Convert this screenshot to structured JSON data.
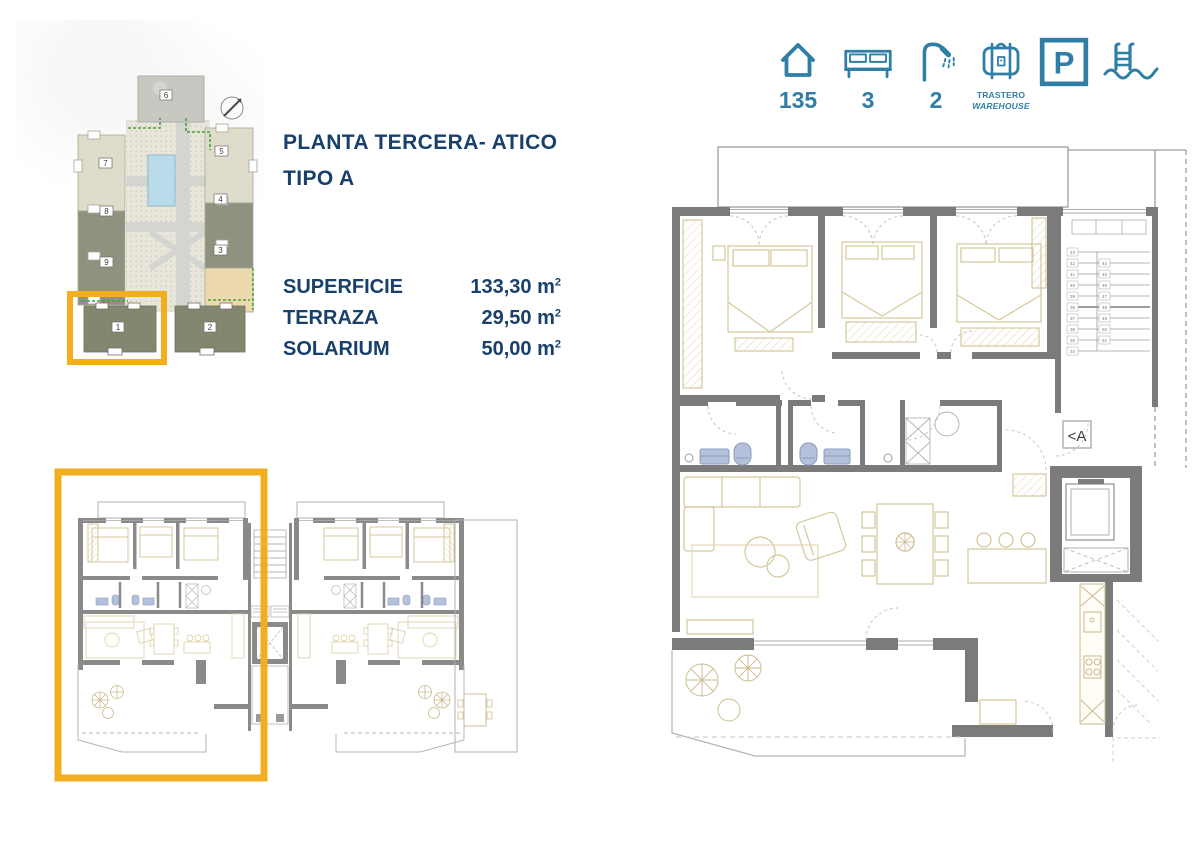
{
  "header": {
    "line1": "PLANTA TERCERA- ATICO",
    "line2": "TIPO A"
  },
  "measurements": {
    "rows": [
      {
        "label": "SUPERFICIE",
        "value": "133,30 m",
        "sup": "2"
      },
      {
        "label": "TERRAZA",
        "value": "29,50 m",
        "sup": "2"
      },
      {
        "label": "SOLARIUM",
        "value": "50,00 m",
        "sup": "2"
      }
    ]
  },
  "amenities": {
    "house": {
      "value": "135"
    },
    "bed": {
      "value": "3"
    },
    "shower": {
      "value": "2"
    },
    "storage": {
      "line1": "TRASTERO",
      "line2": "WAREHOUSE"
    },
    "parking": {
      "letter": "P"
    }
  },
  "site_plan": {
    "building_labels": [
      "1",
      "2",
      "3",
      "4",
      "5",
      "6",
      "7",
      "8",
      "9"
    ]
  },
  "main_plan": {
    "ref": "<A",
    "stairs_left": [
      "43",
      "42",
      "41",
      "40",
      "39",
      "38",
      "37",
      "36",
      "35",
      "34"
    ],
    "stairs_right": [
      "44",
      "45",
      "46",
      "47",
      "48",
      "49",
      "50",
      "51"
    ]
  },
  "colors": {
    "accent_teal": "#2f7ea6",
    "navy": "#18406b",
    "highlight_orange": "#f2ae1f",
    "wall_gray": "#7b7b7b",
    "furniture_tan": "#d6c79b",
    "fixture_blue": "#b4c1da",
    "pool_blue": "#b8dce9"
  }
}
